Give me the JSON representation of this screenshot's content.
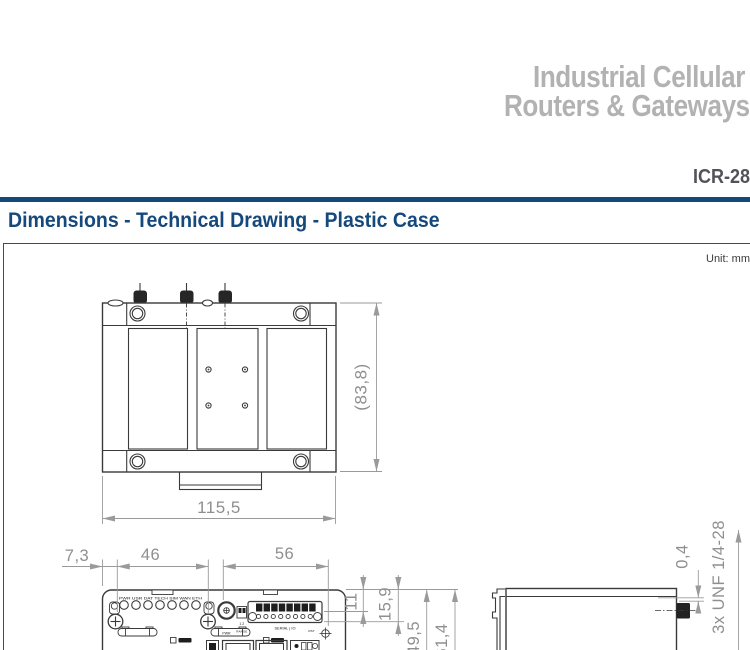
{
  "header": {
    "title_line1": "Industrial Cellular",
    "title_line2": "Routers & Gateways",
    "model": "ICR-28",
    "accent_color": "#15497c",
    "title_color": "#b2b2b2"
  },
  "section": {
    "heading": "Dimensions - Technical Drawing - Plastic Case",
    "unit_label": "Unit: mm"
  },
  "drawing": {
    "top_view": {
      "width_dim": "115,5",
      "depth_dim": "(83,8)"
    },
    "front_view": {
      "horizontal_dims": [
        "7,3",
        "46",
        "56"
      ],
      "vertical_dims": [
        "11",
        "15,9",
        "49,5",
        "61,4"
      ],
      "led_labels": "PWR USR DAT TECH SIM WAN ETH",
      "pwr_label": "PWR",
      "dip_label": "1 2",
      "range_label": "RANGE",
      "serial_label": "SERIAL | IO",
      "rst_label": "RST"
    },
    "side_view": {
      "lip_dim": "0,4",
      "thread_label": "3x UNF 1/4-28"
    }
  }
}
